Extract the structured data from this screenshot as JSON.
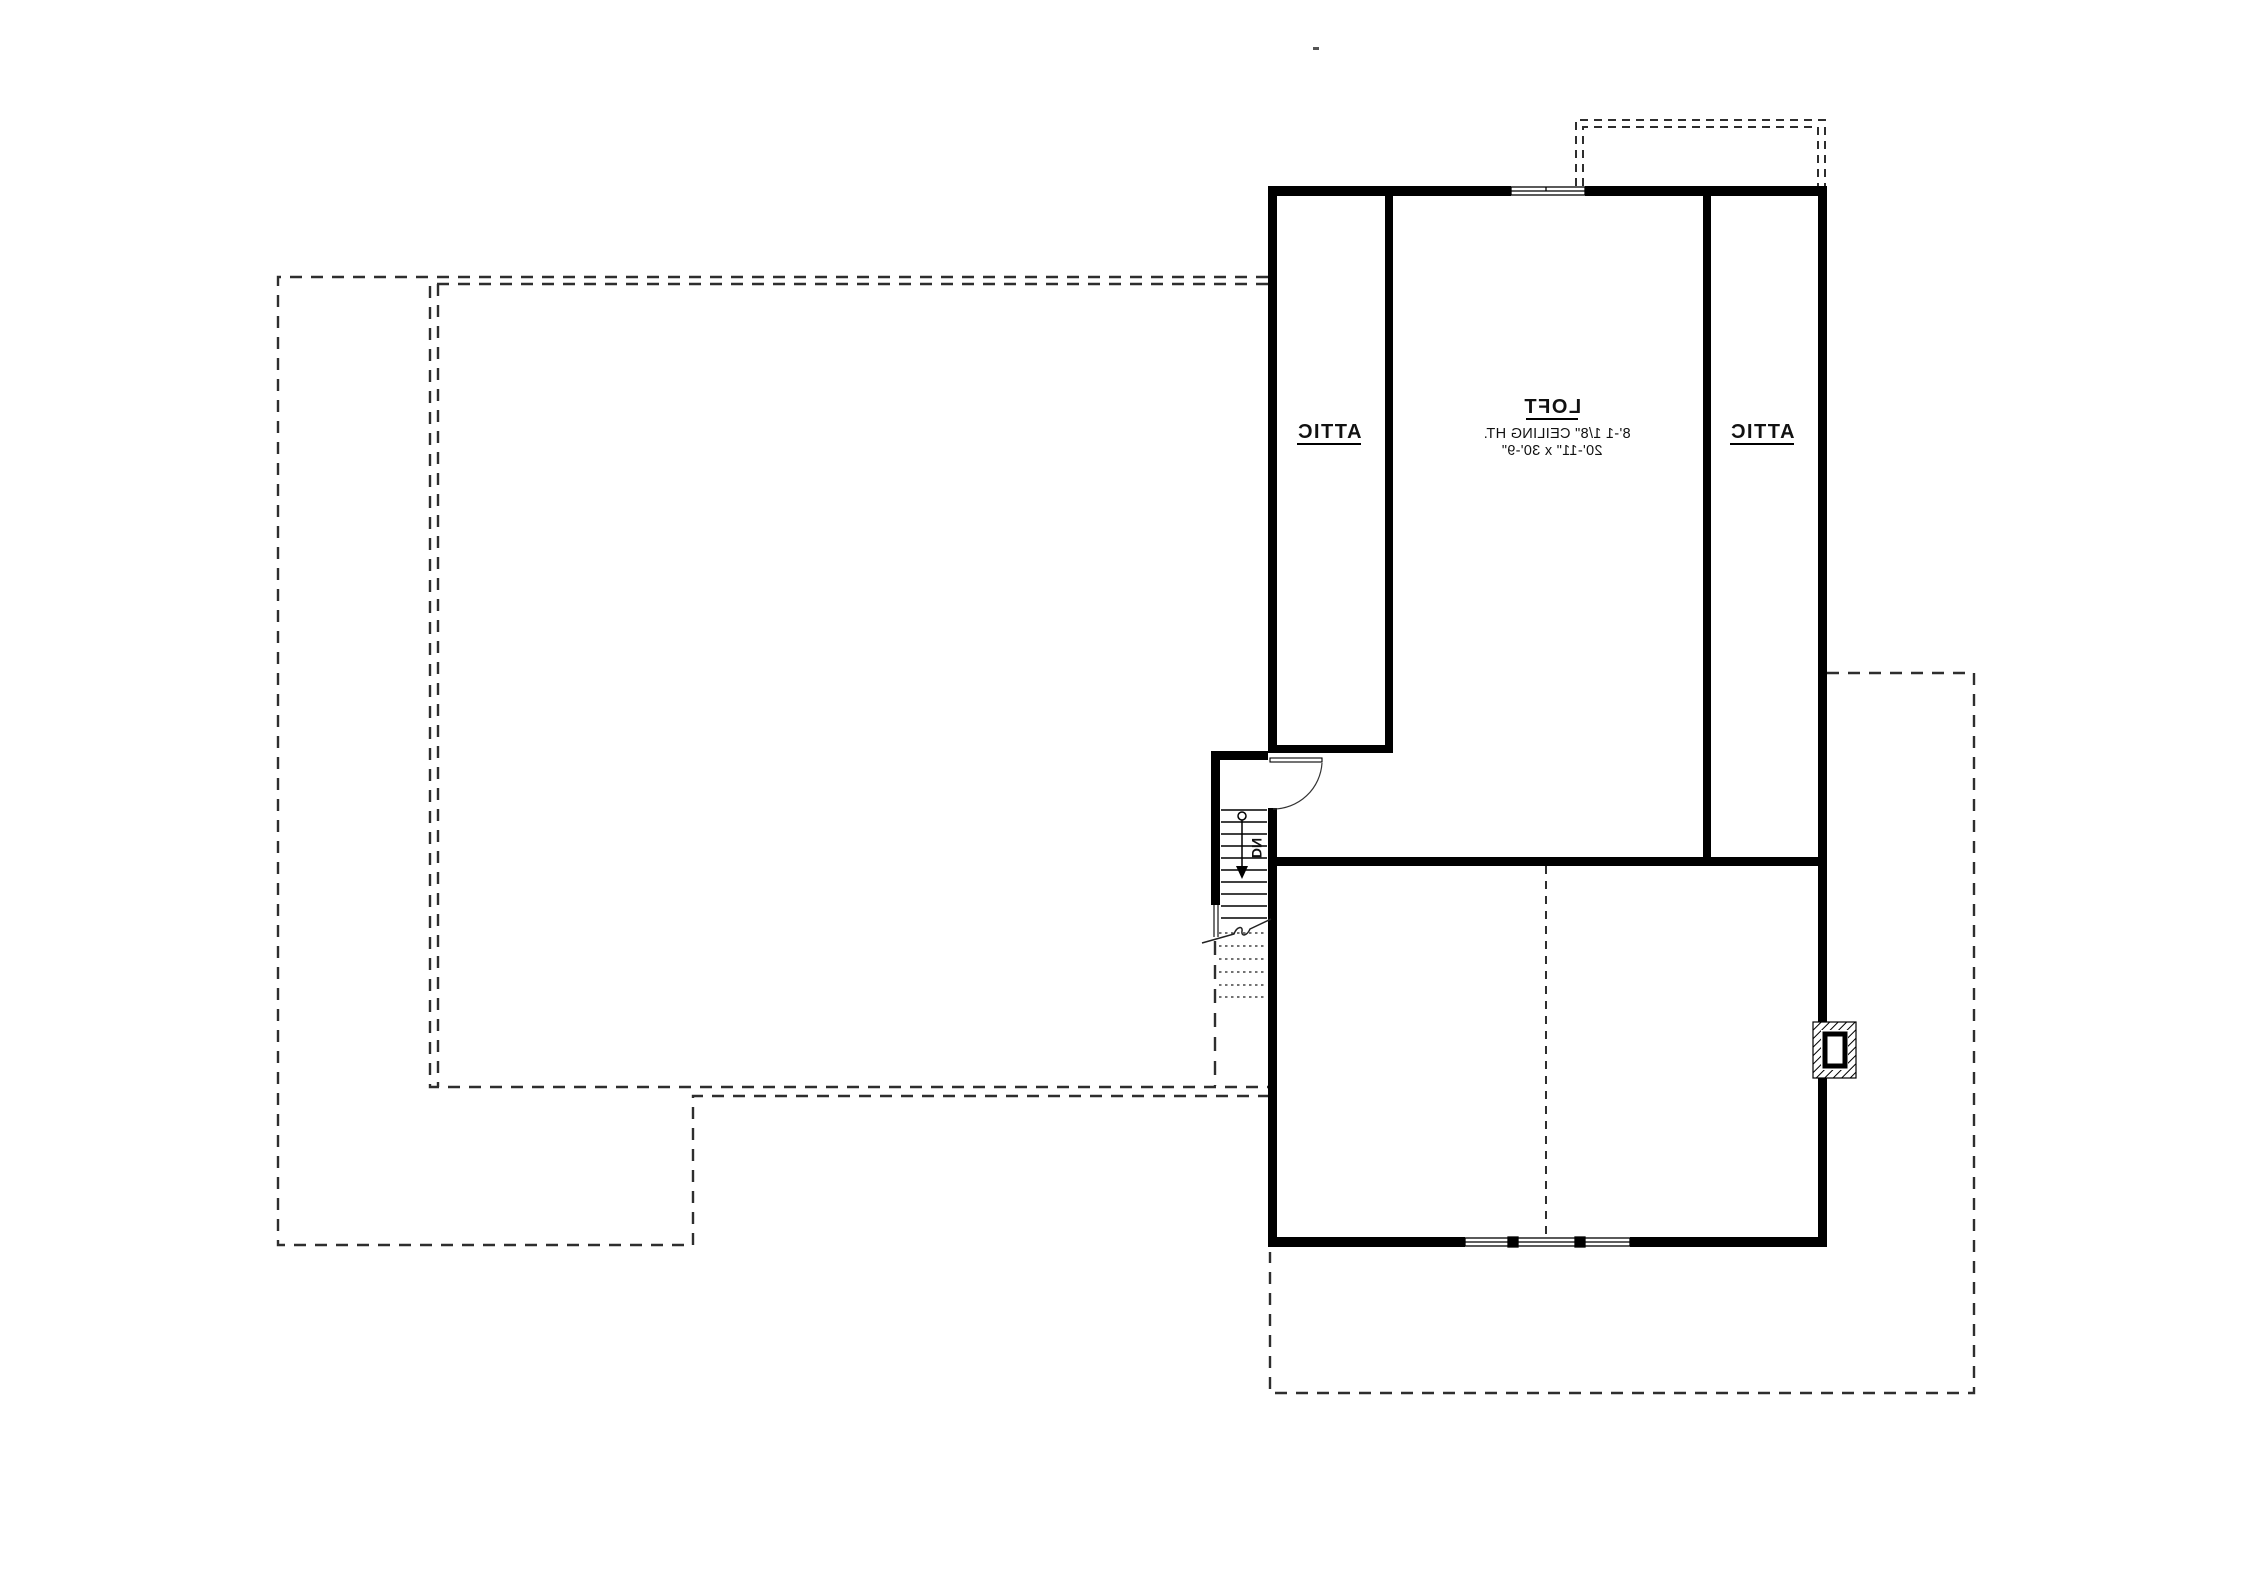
{
  "plan": {
    "rooms": {
      "loft": {
        "label": "LOFT",
        "ceiling": "8'-1 1/8\" CEILING HT.",
        "dimensions": "20'-11\" x 30'-9\""
      },
      "attic_left": {
        "label": "ATTIC"
      },
      "attic_right": {
        "label": "ATTIC"
      },
      "stairs": {
        "label": "DN"
      }
    },
    "colors": {
      "wall": "#000000",
      "dash": "#2e2e2e",
      "thin_line": "#1a1a1a",
      "background": "#ffffff"
    }
  }
}
